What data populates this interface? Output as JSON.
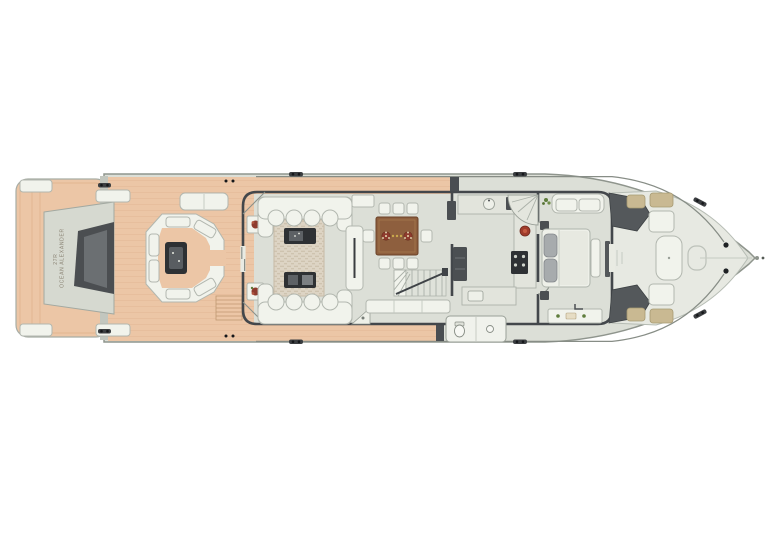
{
  "meta": {
    "title": "Yacht deck plan, overhead view",
    "type": "floor-plan"
  },
  "vessel": {
    "brand": "OCEAN ALEXANDER",
    "model": "27R"
  },
  "colors": {
    "background": "#ffffff",
    "hull": "#dcdfd7",
    "hull_edge": "#8f958d",
    "deck_teak": "#ecc6a6",
    "interior_floor": "#e9ebe3",
    "foredeck": "#e7e9e2",
    "wall": "#43474b",
    "furniture_white": "#f1f3ec",
    "dark_fixture": "#2e3134",
    "wood": "#8e5f3e",
    "rug": "#ddd4c4",
    "cushion_tan": "#c9b992",
    "accent_red": "#a03c2b",
    "plant_green": "#5f7d3c"
  },
  "areas": [
    {
      "id": "swim-platform"
    },
    {
      "id": "aft-deck"
    },
    {
      "id": "salon"
    },
    {
      "id": "dining-area"
    },
    {
      "id": "galley"
    },
    {
      "id": "day-head"
    },
    {
      "id": "master-stateroom"
    },
    {
      "id": "foredeck-lounge"
    },
    {
      "id": "bow"
    }
  ],
  "furniture": [
    {
      "id": "tender-garage",
      "area": "swim-platform"
    },
    {
      "id": "aft-settee",
      "area": "aft-deck"
    },
    {
      "id": "aft-cocktail-table",
      "area": "aft-deck"
    },
    {
      "id": "sunpad",
      "area": "aft-deck"
    },
    {
      "id": "aft-stairs",
      "area": "aft-deck"
    },
    {
      "id": "salon-sofas",
      "area": "salon"
    },
    {
      "id": "coffee-tables",
      "area": "salon"
    },
    {
      "id": "area-rug",
      "area": "salon"
    },
    {
      "id": "sideboard",
      "area": "salon"
    },
    {
      "id": "plant-stands",
      "area": "salon"
    },
    {
      "id": "dining-table",
      "area": "dining-area"
    },
    {
      "id": "dining-chairs",
      "area": "dining-area"
    },
    {
      "id": "credenza",
      "area": "dining-area"
    },
    {
      "id": "lower-deck-stairs",
      "area": "dining-area"
    },
    {
      "id": "galley-counters",
      "area": "galley"
    },
    {
      "id": "cooktop",
      "area": "galley"
    },
    {
      "id": "refrigerator",
      "area": "galley"
    },
    {
      "id": "spiral-staircase",
      "area": "galley"
    },
    {
      "id": "toilet",
      "area": "day-head"
    },
    {
      "id": "king-bed",
      "area": "master-stateroom"
    },
    {
      "id": "master-sofa",
      "area": "master-stateroom"
    },
    {
      "id": "vanity",
      "area": "master-stateroom"
    },
    {
      "id": "foredeck-seats",
      "area": "foredeck-lounge"
    },
    {
      "id": "lounge-pad",
      "area": "foredeck-lounge"
    },
    {
      "id": "anchor-windlass",
      "area": "bow"
    }
  ]
}
